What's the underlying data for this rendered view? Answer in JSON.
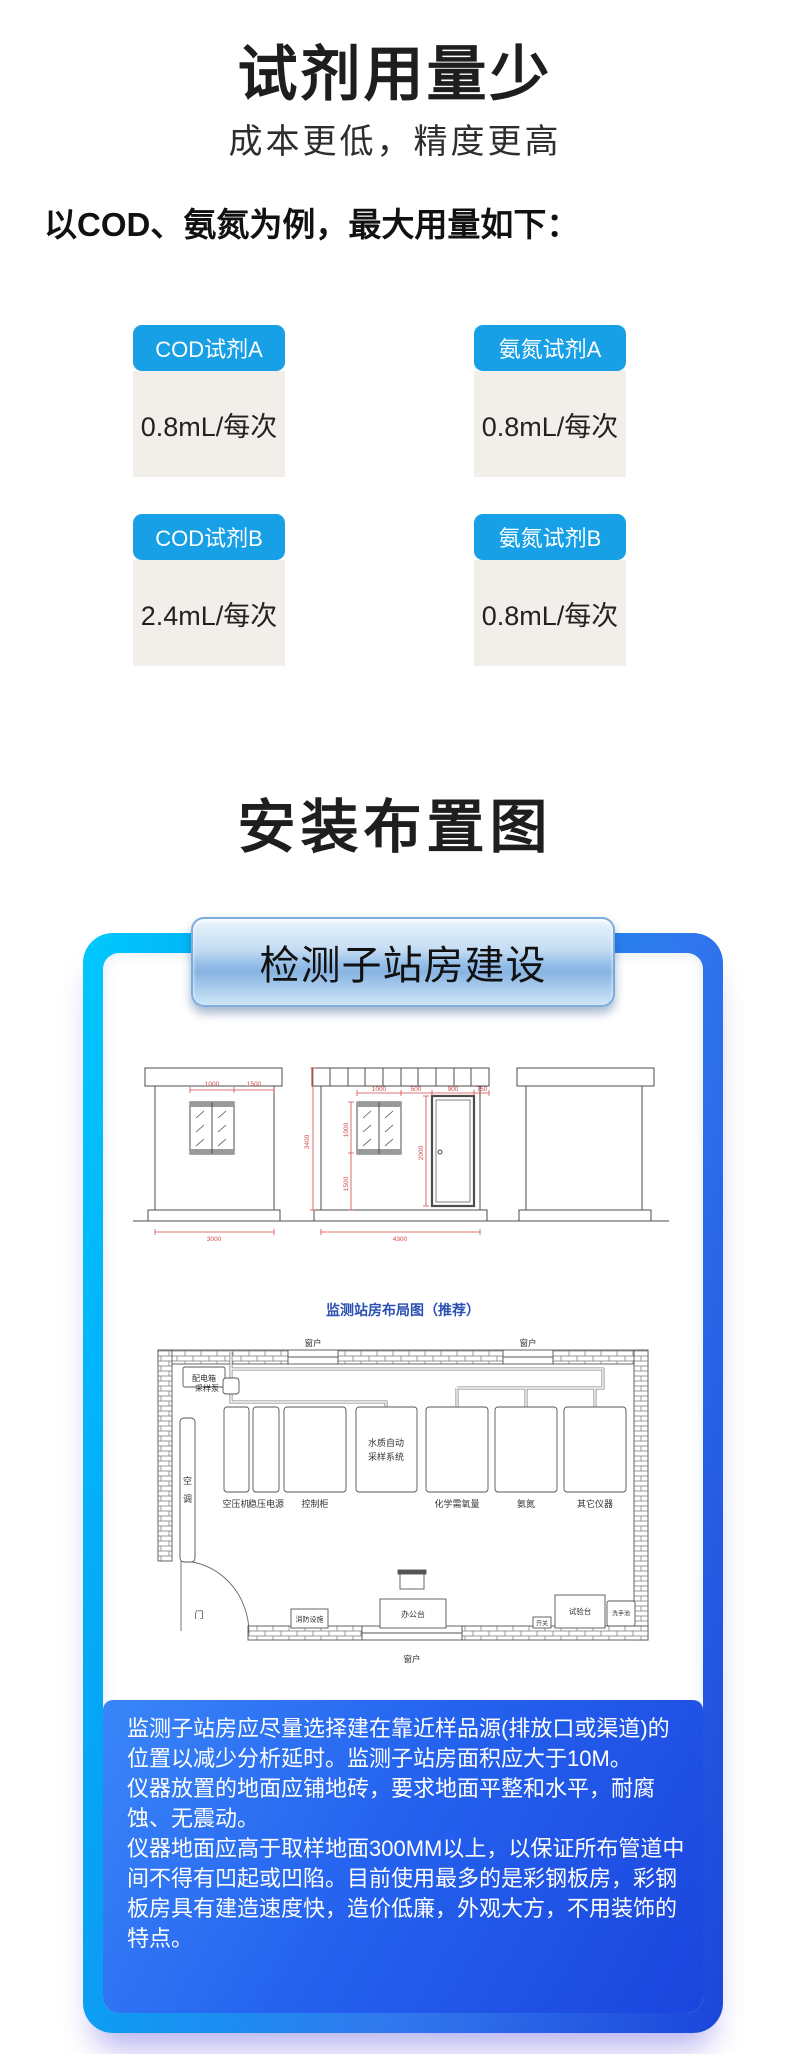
{
  "reagent_section": {
    "title": "试剂用量少",
    "subtitle": "成本更低，精度更高",
    "intro": "以COD、氨氮为例，最大用量如下：",
    "cards": [
      {
        "label": "COD试剂A",
        "value": "0.8mL/每次"
      },
      {
        "label": "氨氮试剂A",
        "value": "0.8mL/每次"
      },
      {
        "label": "COD试剂B",
        "value": "2.4mL/每次"
      },
      {
        "label": "氨氮试剂B",
        "value": "0.8mL/每次"
      }
    ]
  },
  "layout_section": {
    "title": "安装布置图",
    "panel_header": "检测子站房建设",
    "plan_caption": "监测站房布局图（推荐）",
    "notes": [
      "监测子站房应尽量选择建在靠近样品源(排放口或渠道)的位置以减少分析延时。监测子站房面积应大于10M。",
      "仪器放置的地面应铺地砖，要求地面平整和水平，耐腐蚀、无震动。",
      "仪器地面应高于取样地面300MM以上，以保证所布管道中间不得有凹起或凹陷。目前使用最多的是彩钢板房，彩钢板房具有建造速度快，造价低廉，外观大方，不用装饰的特点。"
    ]
  },
  "diagram": {
    "elevations": {
      "left": {
        "dim_top_1": "1000",
        "dim_top_2": "1500",
        "dim_bottom": "3000"
      },
      "middle": {
        "dim_left_height": "3400",
        "dim_top_1": "1000",
        "dim_top_2": "500",
        "dim_top_3": "900",
        "dim_top_4": "750",
        "dim_window": "1000",
        "dim_sill": "1500",
        "dim_door": "2000",
        "dim_bottom": "4300"
      }
    },
    "plan": {
      "window": "窗户",
      "door": "门",
      "power_box": "配电箱",
      "pump": "采样泵",
      "ac_chars": [
        "空",
        "调"
      ],
      "sampler": [
        "水质自动",
        "采样系统"
      ],
      "equipment": [
        "空压机",
        "稳压电源",
        "控制柜",
        "化学需氧量",
        "氨氮",
        "其它仪器"
      ],
      "fire": "消防设施",
      "desk": "办公台",
      "switch": "开关",
      "bench": "试验台",
      "sink": "洗手池"
    }
  },
  "colors": {
    "badge_blue": "#18a0e6",
    "value_box_bg": "#f2efeb",
    "caption_blue": "#2b50b3",
    "card_border_start": "#00c8fd",
    "card_border_end": "#1b46d9",
    "note_bg_start": "#3a86f8",
    "note_bg_end": "#1b45dd",
    "dim_red": "#d34a4a"
  }
}
